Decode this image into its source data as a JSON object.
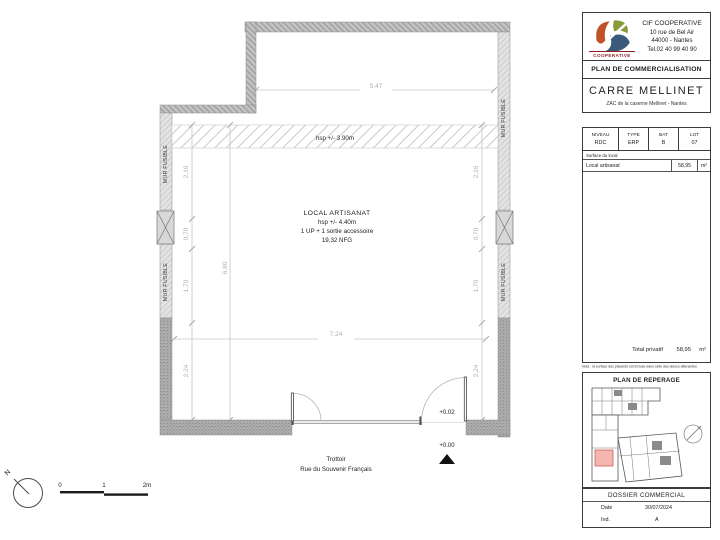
{
  "header": {
    "company_name": "CIF COOPERATIVE",
    "address1": "10 rue de Bel Air",
    "address2": "44000 - Nantes",
    "phone": "Tel.02 40 99 40 90",
    "logo_caption": "COOPERATIVE",
    "doc_type": "PLAN DE COMMERCIALISATION",
    "project_name": "CARRE MELLINET",
    "project_location": "ZAC de la caserne Mellinet - Nantes"
  },
  "info": {
    "col1_label": "NIVEAU",
    "col1_value": "RDC",
    "col2_label": "TYPE",
    "col2_value": "ERP",
    "col3_label": "BAT",
    "col3_value": "B",
    "col4_label": "LOT",
    "col4_value": "07",
    "surface_header": "Surface du local",
    "row_label": "Local artisanat",
    "row_value": "58,95",
    "row_unit": "m²",
    "total_label": "Total privatif",
    "total_value": "58,95",
    "total_unit": "m²",
    "note": "Nota : la surface des placards est incluse dans celle des pièces attenantes"
  },
  "reperage_title": "PLAN DE REPERAGE",
  "dossier": {
    "title": "DOSSIER COMMERCIAL",
    "date_label": "Date",
    "date_value": "30/07/2024",
    "ind_label": "Ind.",
    "ind_value": "A"
  },
  "plan": {
    "room_name": "LOCAL ARTISANAT",
    "room_hsp": "hsp +/- 4.40m",
    "room_access": "1 UP + 1 sortie accessoire",
    "room_nfg": "19,32 NFG",
    "band_hsp": "hsp +/- 3.90m",
    "mur_fusible": "MUR FUSIBLE",
    "level_inside": "+0.02",
    "level_outside": "+0.00",
    "street1": "Trottoir",
    "street2": "Rue du Souvenir Français",
    "dims": {
      "top": "5,47",
      "width": "7,24",
      "height_total": "6,80",
      "seg1": "2,16",
      "seg2": "0,70",
      "seg3": "1,70",
      "seg4": "2,24"
    }
  },
  "scalebar": {
    "north": "N",
    "t0": "0",
    "t1": "1",
    "t2": "2m"
  },
  "colors": {
    "highlight": "#f5b5b0",
    "logo_red": "#8f1f1f",
    "logo_orange": "#bf5226",
    "logo_green": "#8a9a3a",
    "logo_blue": "#3a5a7a"
  }
}
